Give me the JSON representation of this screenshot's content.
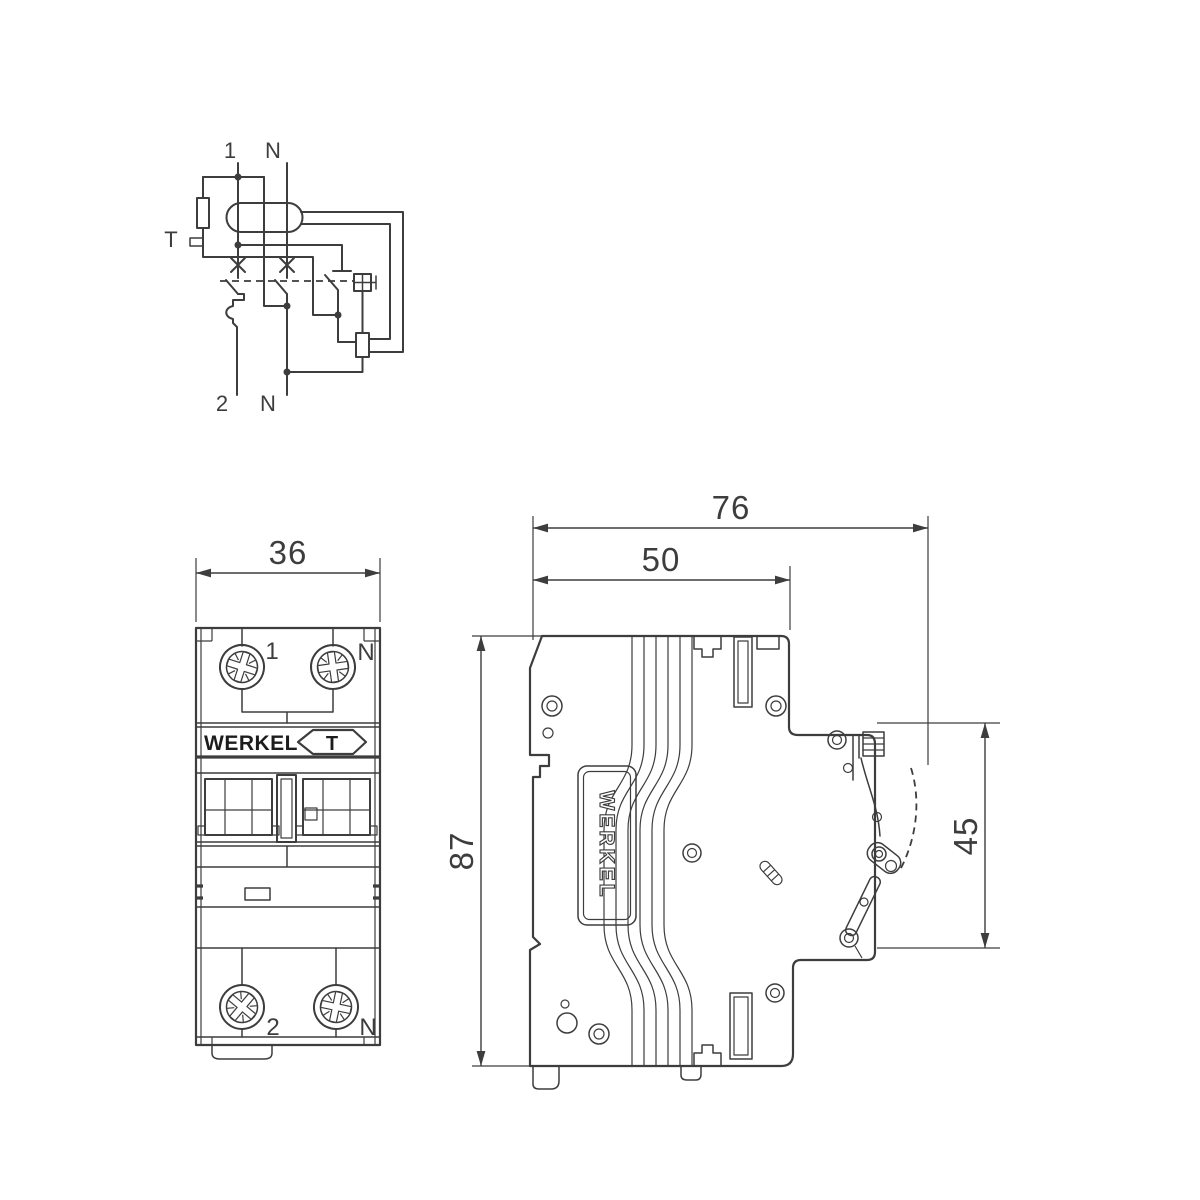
{
  "drawing_title": "Werkel RCBO dimensional drawing",
  "colors": {
    "line": "#3d3d3d",
    "background": "#ffffff"
  },
  "schematic": {
    "terminal_top_left": "1",
    "terminal_top_right": "N",
    "terminal_bottom_left": "2",
    "terminal_bottom_right": "N",
    "test_button_label": "T"
  },
  "front_view": {
    "width_mm": "36",
    "terminal_top_left": "1",
    "terminal_top_right": "N",
    "terminal_bottom_left": "2",
    "terminal_bottom_right": "N",
    "brand": "WERKEL",
    "test_button_label": "T"
  },
  "side_view": {
    "overall_depth_mm": "76",
    "body_depth_mm": "50",
    "height_mm": "87",
    "handle_zone_mm": "45",
    "brand_vertical": "WERKEL"
  }
}
